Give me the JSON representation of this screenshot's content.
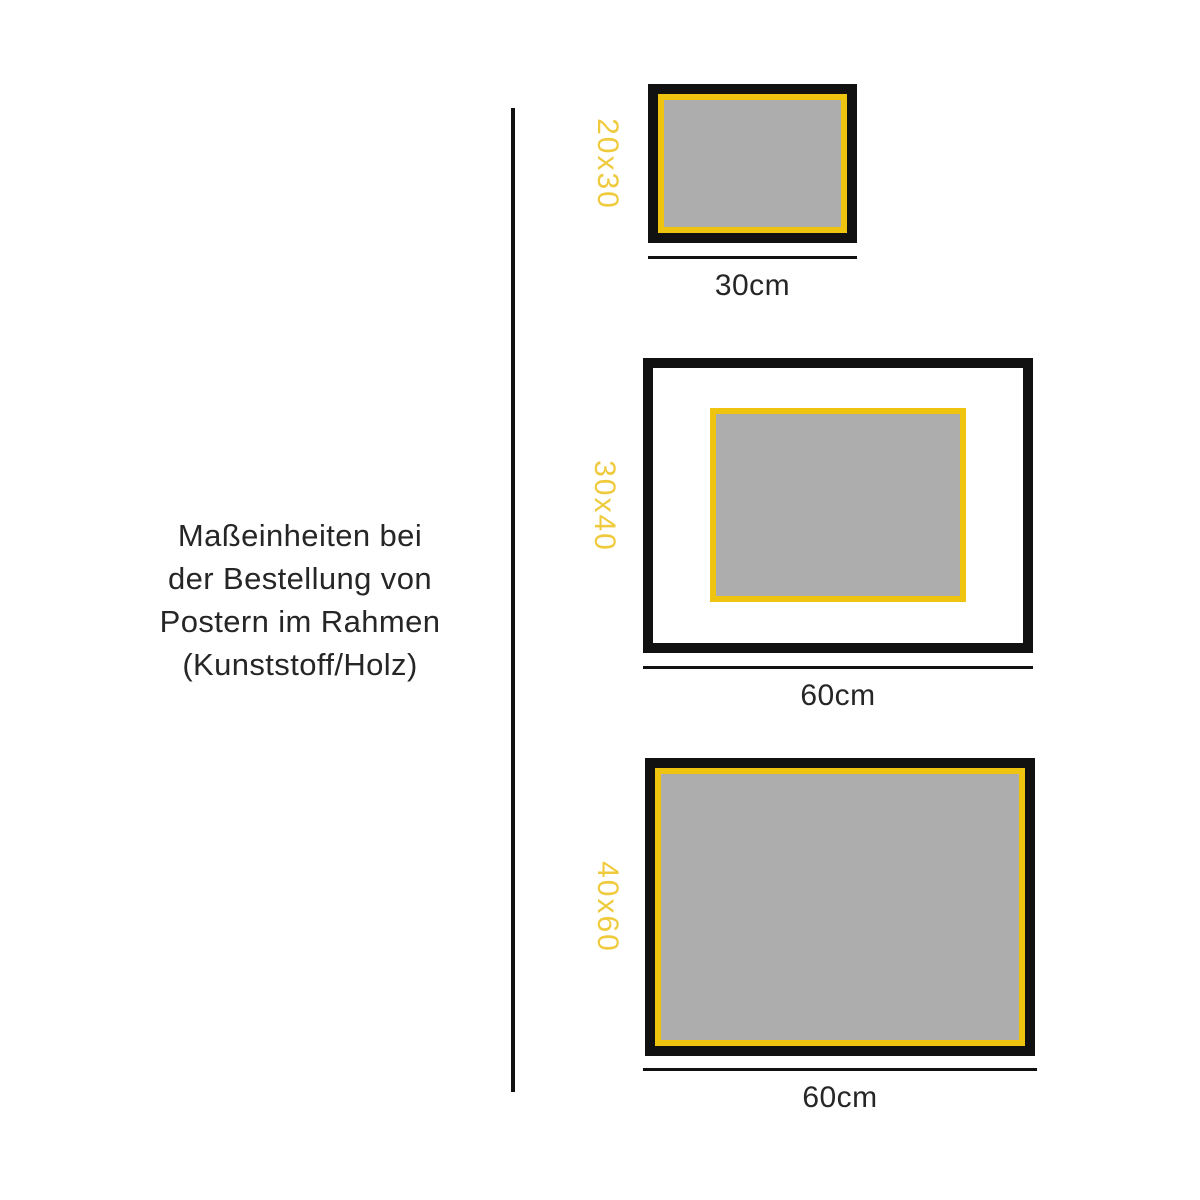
{
  "colors": {
    "frame_black": "#111111",
    "text_black": "#262626",
    "frame_yellow": "#EEC40F",
    "label_yellow": "#F0CA3D",
    "poster_gray": "#ADADAD",
    "background": "#FFFFFF"
  },
  "caption": {
    "lines": [
      "Maßeinheiten bei",
      "der Bestellung von",
      "Postern im Rahmen",
      "(Kunststoff/Holz)"
    ]
  },
  "frames": [
    {
      "size_label": "20x30",
      "width_label": "30cm",
      "poster_fills_frame": true
    },
    {
      "size_label": "30x40",
      "width_label": "60cm",
      "poster_fills_frame": false
    },
    {
      "size_label": "40x60",
      "width_label": "60cm",
      "poster_fills_frame": true
    }
  ]
}
